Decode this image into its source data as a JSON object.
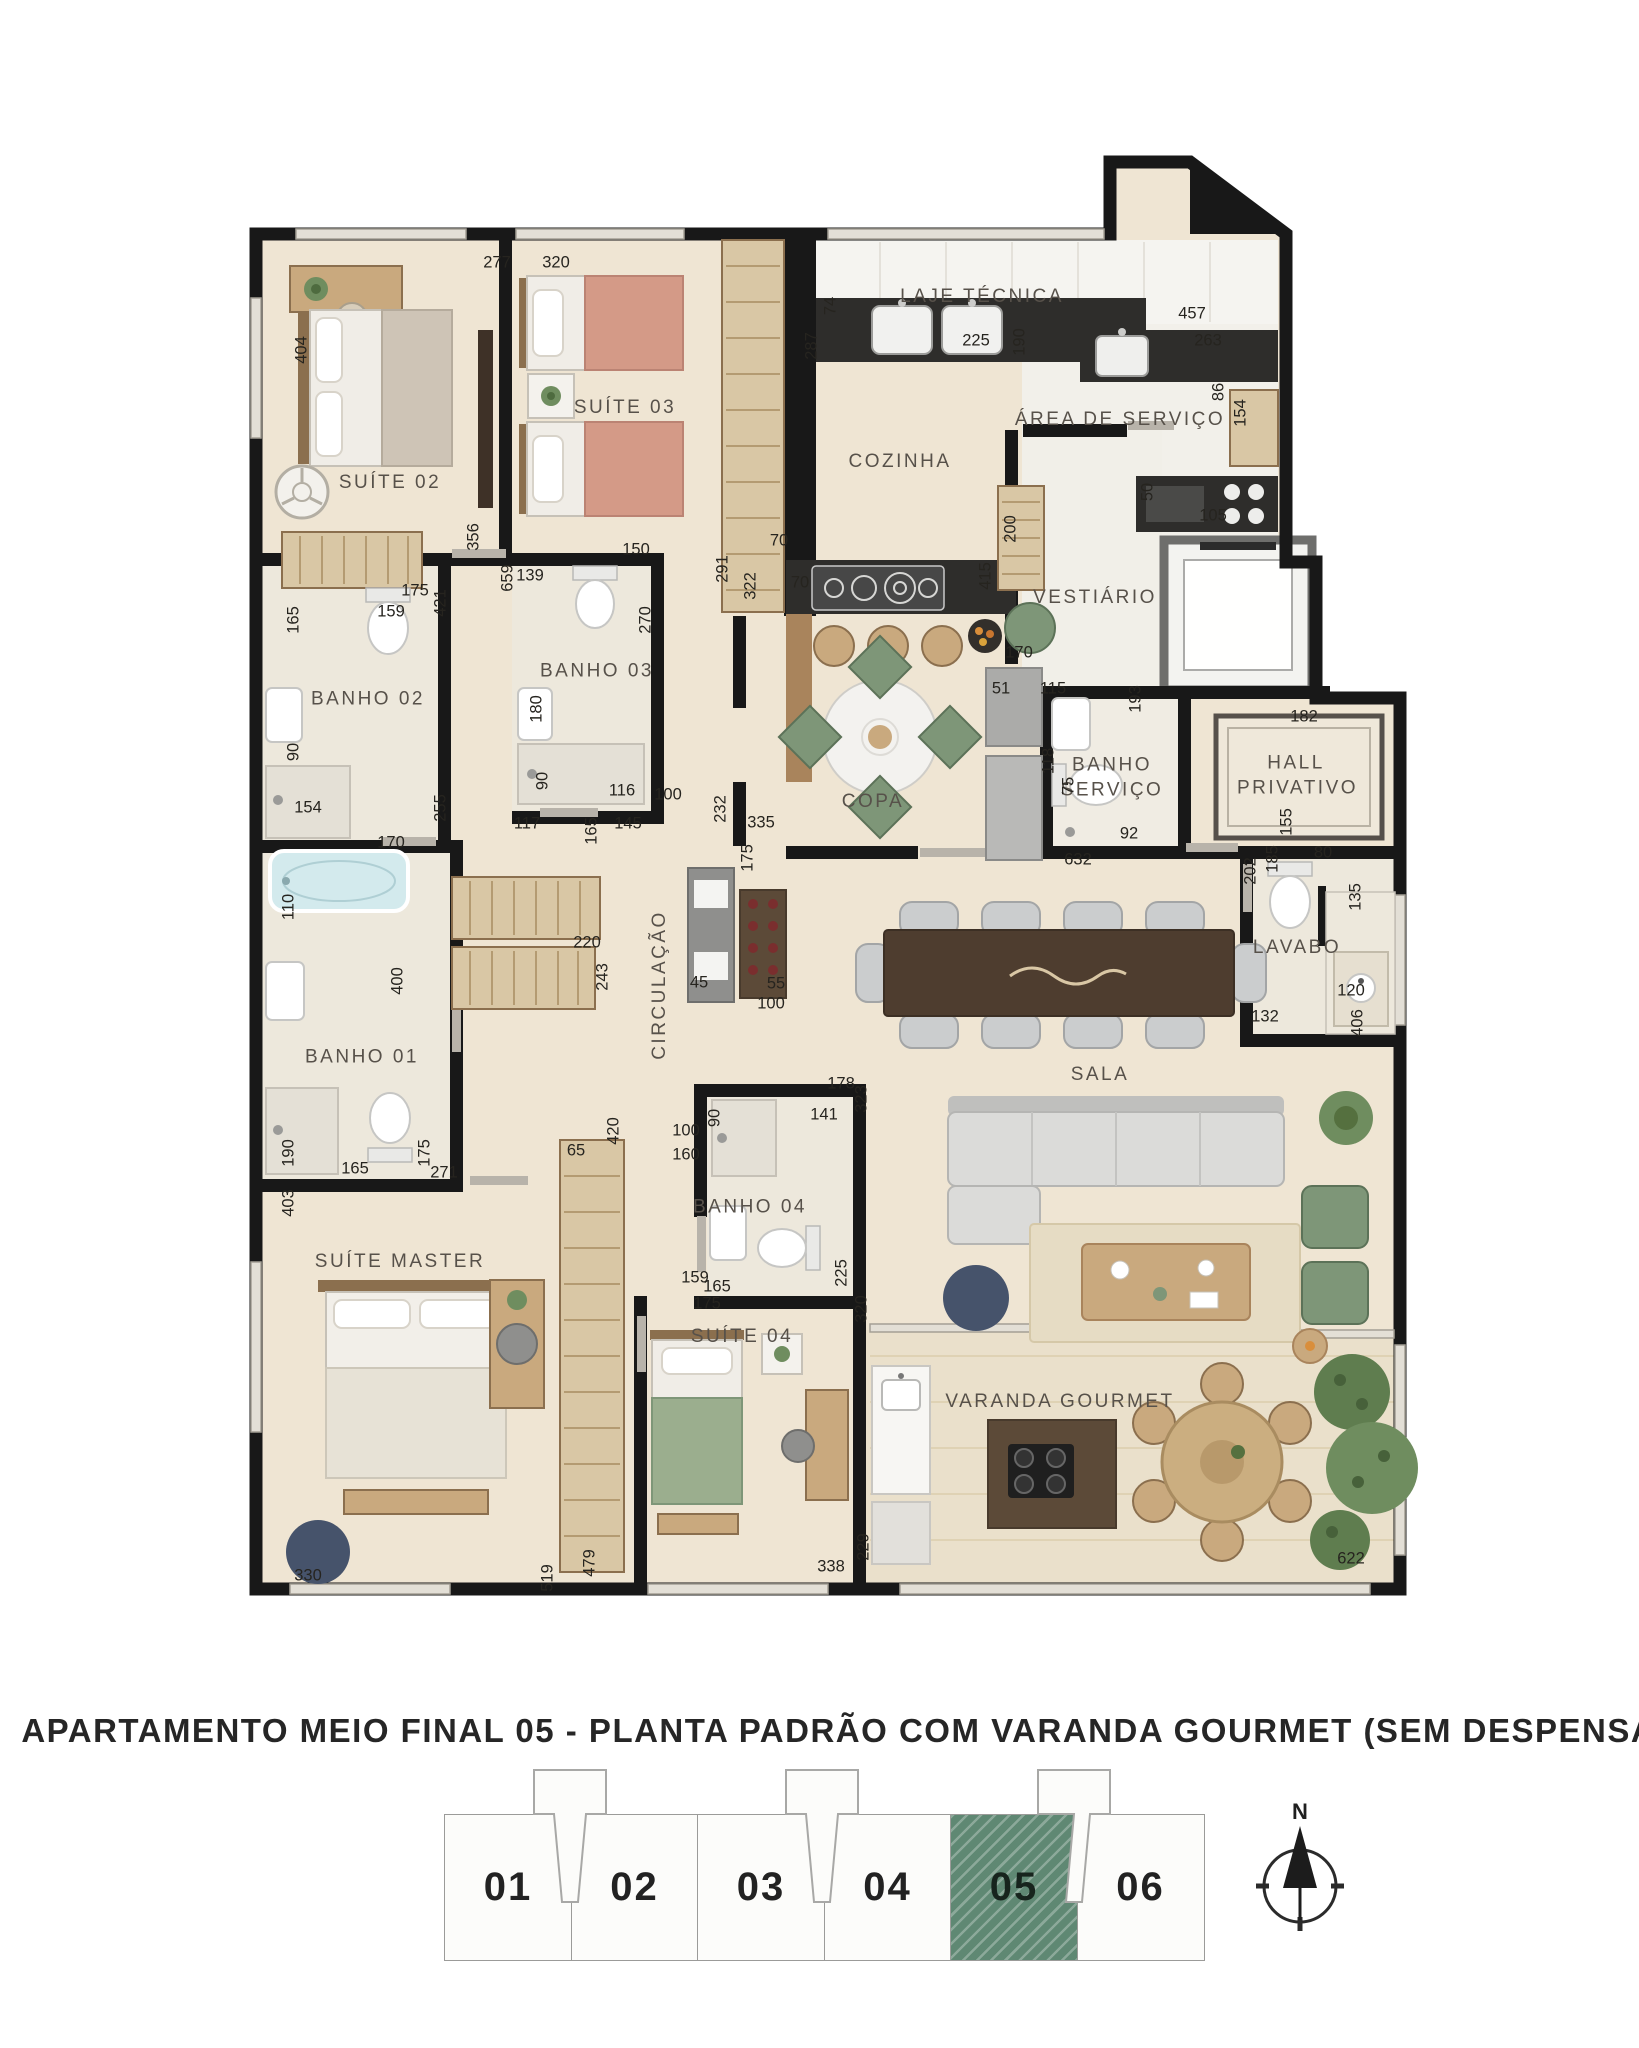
{
  "title": "APARTAMENTO MEIO FINAL 05 - PLANTA PADRÃO COM VARANDA GOURMET (SEM DESPENSA)",
  "compass": {
    "label": "N"
  },
  "colors": {
    "wall": "#181818",
    "floor": "#EFE5D3",
    "keyplan_highlight": "#5F8873",
    "accent_green": "#7E9678"
  },
  "keyplan": {
    "units": [
      {
        "label": "01",
        "highlighted": false
      },
      {
        "label": "02",
        "highlighted": false
      },
      {
        "label": "03",
        "highlighted": false
      },
      {
        "label": "04",
        "highlighted": false
      },
      {
        "label": "05",
        "highlighted": true
      },
      {
        "label": "06",
        "highlighted": false
      }
    ]
  },
  "plan": {
    "rooms": [
      {
        "label": "SUÍTE 02",
        "x": 390,
        "y": 483
      },
      {
        "label": "SUÍTE 03",
        "x": 625,
        "y": 408
      },
      {
        "label": "LAJE TÉCNICA",
        "x": 982,
        "y": 297
      },
      {
        "label": "COZINHA",
        "x": 900,
        "y": 462
      },
      {
        "label": "ÁREA DE SERVIÇO",
        "x": 1120,
        "y": 420
      },
      {
        "label": "VESTIÁRIO",
        "x": 1095,
        "y": 598
      },
      {
        "label": "BANHO 02",
        "x": 368,
        "y": 700,
        "wrap": true
      },
      {
        "label": "BANHO 03",
        "x": 597,
        "y": 672,
        "wrap": true
      },
      {
        "label": "COPA",
        "x": 873,
        "y": 802
      },
      {
        "label": "BANHO SERVIÇO",
        "x": 1112,
        "y": 778,
        "wrap": true
      },
      {
        "label": "HALL PRIVATIVO",
        "x": 1296,
        "y": 776,
        "wrap": true
      },
      {
        "label": "CIRCULAÇÃO",
        "x": 660,
        "y": 985,
        "rot": true
      },
      {
        "label": "LAVABO",
        "x": 1297,
        "y": 948
      },
      {
        "label": "SALA",
        "x": 1100,
        "y": 1075
      },
      {
        "label": "BANHO 01",
        "x": 362,
        "y": 1058,
        "wrap": true
      },
      {
        "label": "SUÍTE MASTER",
        "x": 400,
        "y": 1262
      },
      {
        "label": "BANHO 04",
        "x": 750,
        "y": 1208,
        "wrap": true
      },
      {
        "label": "SUÍTE 04",
        "x": 742,
        "y": 1337
      },
      {
        "label": "VARANDA GOURMET",
        "x": 1060,
        "y": 1402
      }
    ],
    "dims": [
      {
        "t": "404",
        "x": 302,
        "y": 350,
        "r": true
      },
      {
        "t": "277",
        "x": 497,
        "y": 263
      },
      {
        "t": "320",
        "x": 556,
        "y": 263
      },
      {
        "t": "74",
        "x": 831,
        "y": 306,
        "r": true
      },
      {
        "t": "287",
        "x": 812,
        "y": 346,
        "r": true
      },
      {
        "t": "225",
        "x": 976,
        "y": 341
      },
      {
        "t": "190",
        "x": 1020,
        "y": 342,
        "r": true
      },
      {
        "t": "457",
        "x": 1192,
        "y": 314
      },
      {
        "t": "263",
        "x": 1208,
        "y": 341
      },
      {
        "t": "86",
        "x": 1219,
        "y": 392,
        "r": true
      },
      {
        "t": "154",
        "x": 1241,
        "y": 413,
        "r": true
      },
      {
        "t": "356",
        "x": 474,
        "y": 537,
        "r": true
      },
      {
        "t": "150",
        "x": 636,
        "y": 550
      },
      {
        "t": "139",
        "x": 530,
        "y": 576
      },
      {
        "t": "659",
        "x": 508,
        "y": 578,
        "r": true
      },
      {
        "t": "421",
        "x": 441,
        "y": 603,
        "r": true
      },
      {
        "t": "175",
        "x": 415,
        "y": 591
      },
      {
        "t": "165",
        "x": 294,
        "y": 620,
        "r": true
      },
      {
        "t": "159",
        "x": 391,
        "y": 612
      },
      {
        "t": "270",
        "x": 646,
        "y": 620,
        "r": true
      },
      {
        "t": "180",
        "x": 537,
        "y": 709,
        "r": true
      },
      {
        "t": "90",
        "x": 294,
        "y": 752,
        "r": true
      },
      {
        "t": "154",
        "x": 308,
        "y": 808
      },
      {
        "t": "255",
        "x": 441,
        "y": 808,
        "r": true
      },
      {
        "t": "90",
        "x": 543,
        "y": 781,
        "r": true
      },
      {
        "t": "116",
        "x": 622,
        "y": 791
      },
      {
        "t": "100",
        "x": 668,
        "y": 795
      },
      {
        "t": "117",
        "x": 527,
        "y": 824
      },
      {
        "t": "165",
        "x": 592,
        "y": 831,
        "r": true
      },
      {
        "t": "145",
        "x": 628,
        "y": 824
      },
      {
        "t": "170",
        "x": 391,
        "y": 843
      },
      {
        "t": "291",
        "x": 723,
        "y": 569,
        "r": true
      },
      {
        "t": "70",
        "x": 779,
        "y": 541
      },
      {
        "t": "322",
        "x": 751,
        "y": 586,
        "r": true
      },
      {
        "t": "70",
        "x": 800,
        "y": 583
      },
      {
        "t": "415",
        "x": 986,
        "y": 576,
        "r": true
      },
      {
        "t": "200",
        "x": 1011,
        "y": 529,
        "r": true
      },
      {
        "t": "170",
        "x": 1019,
        "y": 653
      },
      {
        "t": "50",
        "x": 1148,
        "y": 492,
        "r": true
      },
      {
        "t": "105",
        "x": 1213,
        "y": 516
      },
      {
        "t": "51",
        "x": 1001,
        "y": 689
      },
      {
        "t": "115",
        "x": 1053,
        "y": 689
      },
      {
        "t": "118",
        "x": 1049,
        "y": 761,
        "r": true
      },
      {
        "t": "75",
        "x": 1069,
        "y": 786,
        "r": true
      },
      {
        "t": "193",
        "x": 1136,
        "y": 699,
        "r": true
      },
      {
        "t": "92",
        "x": 1129,
        "y": 834
      },
      {
        "t": "632",
        "x": 1078,
        "y": 860
      },
      {
        "t": "182",
        "x": 1304,
        "y": 717
      },
      {
        "t": "155",
        "x": 1287,
        "y": 822,
        "r": true
      },
      {
        "t": "202",
        "x": 1251,
        "y": 871,
        "r": true
      },
      {
        "t": "185",
        "x": 1273,
        "y": 859,
        "r": true
      },
      {
        "t": "80",
        "x": 1323,
        "y": 853
      },
      {
        "t": "135",
        "x": 1356,
        "y": 897,
        "r": true
      },
      {
        "t": "120",
        "x": 1351,
        "y": 991
      },
      {
        "t": "132",
        "x": 1265,
        "y": 1017
      },
      {
        "t": "406",
        "x": 1358,
        "y": 1023,
        "r": true
      },
      {
        "t": "220",
        "x": 587,
        "y": 943
      },
      {
        "t": "243",
        "x": 603,
        "y": 977,
        "r": true
      },
      {
        "t": "45",
        "x": 699,
        "y": 983
      },
      {
        "t": "55",
        "x": 776,
        "y": 984
      },
      {
        "t": "100",
        "x": 771,
        "y": 1004
      },
      {
        "t": "175",
        "x": 748,
        "y": 858,
        "r": true
      },
      {
        "t": "232",
        "x": 721,
        "y": 809,
        "r": true
      },
      {
        "t": "335",
        "x": 761,
        "y": 823
      },
      {
        "t": "110",
        "x": 289,
        "y": 907,
        "r": true
      },
      {
        "t": "400",
        "x": 398,
        "y": 981,
        "r": true
      },
      {
        "t": "190",
        "x": 289,
        "y": 1153,
        "r": true
      },
      {
        "t": "165",
        "x": 355,
        "y": 1169
      },
      {
        "t": "271",
        "x": 444,
        "y": 1173
      },
      {
        "t": "175",
        "x": 425,
        "y": 1153,
        "r": true
      },
      {
        "t": "403",
        "x": 289,
        "y": 1203,
        "r": true
      },
      {
        "t": "330",
        "x": 308,
        "y": 1576
      },
      {
        "t": "65",
        "x": 576,
        "y": 1151
      },
      {
        "t": "420",
        "x": 614,
        "y": 1131,
        "r": true
      },
      {
        "t": "100",
        "x": 686,
        "y": 1131
      },
      {
        "t": "160",
        "x": 686,
        "y": 1155
      },
      {
        "t": "90",
        "x": 715,
        "y": 1118,
        "r": true
      },
      {
        "t": "141",
        "x": 824,
        "y": 1115
      },
      {
        "t": "178",
        "x": 841,
        "y": 1084
      },
      {
        "t": "323",
        "x": 862,
        "y": 1099,
        "r": true
      },
      {
        "t": "159",
        "x": 695,
        "y": 1278
      },
      {
        "t": "165",
        "x": 717,
        "y": 1287
      },
      {
        "t": "175",
        "x": 707,
        "y": 1304
      },
      {
        "t": "225",
        "x": 842,
        "y": 1273,
        "r": true
      },
      {
        "t": "320",
        "x": 862,
        "y": 1309,
        "r": true
      },
      {
        "t": "519",
        "x": 548,
        "y": 1578,
        "r": true
      },
      {
        "t": "479",
        "x": 590,
        "y": 1563,
        "r": true
      },
      {
        "t": "338",
        "x": 831,
        "y": 1567
      },
      {
        "t": "229",
        "x": 864,
        "y": 1547,
        "r": true
      },
      {
        "t": "622",
        "x": 1351,
        "y": 1559
      }
    ]
  }
}
